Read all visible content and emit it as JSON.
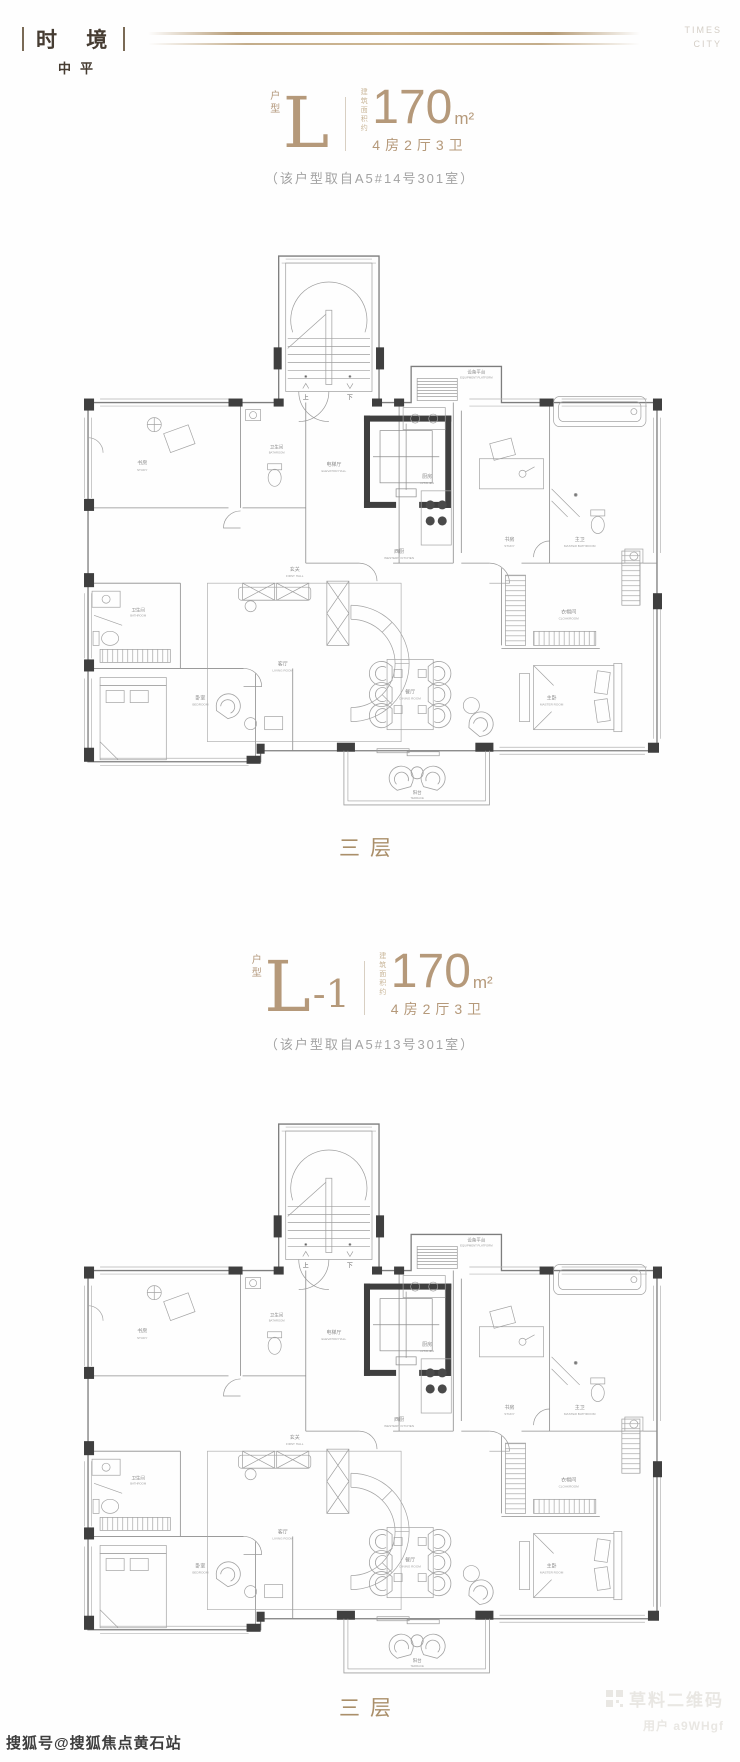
{
  "header": {
    "logo_cn": "时 境",
    "logo_sub": "中平",
    "brand_line1": "TIMES",
    "brand_line2": "CITY"
  },
  "colors": {
    "gold": "#b5997a",
    "floor_label_gold": "#aa8f6a",
    "note_gray": "#a3a3a3",
    "plan_wall": "#7d7d7d",
    "plan_dark_block": "#3f3f3f"
  },
  "sections": [
    {
      "unit_prefix": "户型",
      "unit_main": "L",
      "unit_suffix": "",
      "area_prefix": "建筑面积约",
      "area_value": "170",
      "area_unit": "m²",
      "rooms_summary": "4房2厅3卫",
      "note": "（该户型取自A5#14号301室）",
      "floor_label": "三层"
    },
    {
      "unit_prefix": "户型",
      "unit_main": "L",
      "unit_suffix": "-1",
      "area_prefix": "建筑面积约",
      "area_value": "170",
      "area_unit": "m²",
      "rooms_summary": "4房2厅3卫",
      "note": "（该户型取自A5#13号301室）",
      "floor_label": "三层"
    }
  ],
  "floorplan_labels": {
    "stairs_up": "上",
    "stairs_down": "下",
    "equipment": {
      "cn": "设备平台",
      "en": "EQUIPMENT PLATFORM"
    },
    "elevator_hall": {
      "cn": "电梯厅",
      "en": "ELEVATOR HALL"
    },
    "kitchen": {
      "cn": "厨房",
      "en": "KITCHEN"
    },
    "western_kitchen": {
      "cn": "西厨",
      "en": "WESTERN KITCHEN"
    },
    "first_hall": {
      "cn": "玄关",
      "en": "FIRST HALL"
    },
    "study": {
      "cn": "书房",
      "en": "STUDY"
    },
    "bathroom": {
      "cn": "卫生间",
      "en": "BATHROOM"
    },
    "master_bathroom": {
      "cn": "主卫",
      "en": "MASTER BATHROOM"
    },
    "bedroom": {
      "cn": "卧室",
      "en": "BEDROOM"
    },
    "living_room": {
      "cn": "客厅",
      "en": "LIVING ROOM"
    },
    "dining_room": {
      "cn": "餐厅",
      "en": "DINING ROOM"
    },
    "cloakroom": {
      "cn": "衣帽间",
      "en": "CLOAKROOM"
    },
    "master_room": {
      "cn": "主卧",
      "en": "MASTER ROOM"
    },
    "terrace": {
      "cn": "阳台",
      "en": "TERRACE"
    }
  },
  "watermarks": {
    "bottom_left": "搜狐号@搜狐焦点黄石站",
    "qr_brand": "草料二维码",
    "qr_user": "用户 a9WHgf"
  }
}
